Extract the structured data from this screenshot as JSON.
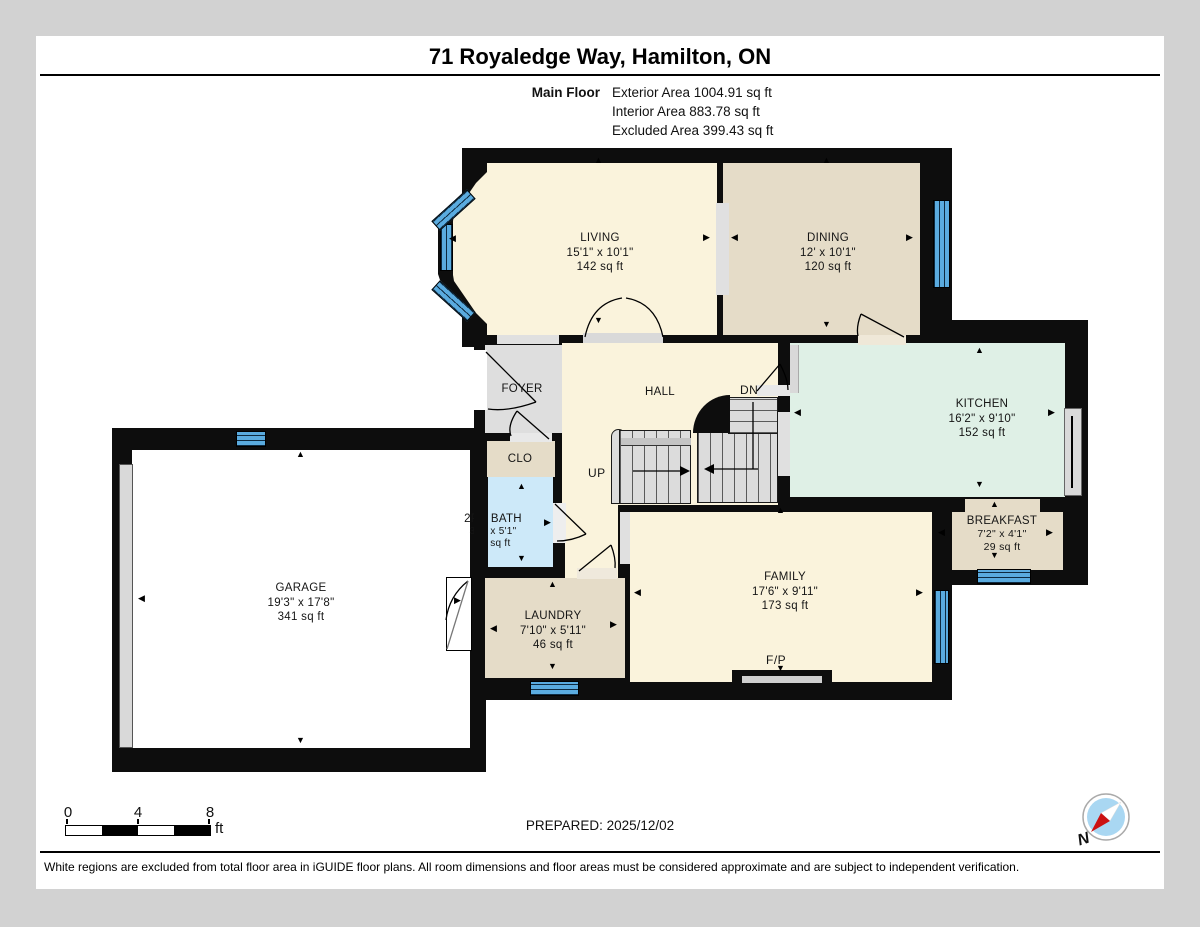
{
  "header": {
    "title": "71 Royaledge Way, Hamilton, ON",
    "floor_label": "Main Floor",
    "exterior_area": "Exterior Area 1004.91 sq ft",
    "interior_area": "Interior Area 883.78 sq ft",
    "excluded_area": "Excluded Area 399.43 sq ft"
  },
  "plan": {
    "rooms": [
      {
        "name": "LIVING",
        "dims": "15'1\" x 10'1\"",
        "area": "142 sq ft"
      },
      {
        "name": "DINING",
        "dims": "12' x 10'1\"",
        "area": "120 sq ft"
      },
      {
        "name": "KITCHEN",
        "dims": "16'2\" x 9'10\"",
        "area": "152 sq ft"
      },
      {
        "name": "BREAKFAST",
        "dims": "7'2\" x 4'1\"",
        "area": "29 sq ft"
      },
      {
        "name": "FAMILY",
        "dims": "17'6\" x 9'11\"",
        "area": "173 sq ft"
      },
      {
        "name": "HALL",
        "dims": "",
        "area": ""
      },
      {
        "name": "FOYER",
        "dims": "",
        "area": ""
      },
      {
        "name": "CLO",
        "dims": "",
        "area": ""
      },
      {
        "name": "2PC BATH",
        "dims": "3'6\" x 5'1\"",
        "area": "18 sq ft"
      },
      {
        "name": "LAUNDRY",
        "dims": "7'10\" x 5'11\"",
        "area": "46 sq ft"
      },
      {
        "name": "GARAGE",
        "dims": "19'3\" x 17'8\"",
        "area": "341 sq ft"
      }
    ],
    "labels": {
      "up": "UP",
      "down": "DN",
      "fireplace": "F/P",
      "north": "N"
    }
  },
  "footer": {
    "scale_ticks": [
      "0",
      "4",
      "8"
    ],
    "scale_unit": "ft",
    "prepared": "PREPARED: 2025/12/02",
    "disclaimer": "White regions are excluded from total floor area in iGUIDE floor plans. All room dimensions and floor areas must be considered approximate and are subject to independent verification."
  },
  "colors": {
    "wall": "#0d0d0d",
    "window_blue": "#5aabdf",
    "cream": "#faf3dc",
    "tan": "#e5dcc8",
    "mint": "#dff0e6",
    "bath_blue": "#cde9f9",
    "foyer_gray": "#dedede",
    "excluded_white": "#ffffff"
  }
}
